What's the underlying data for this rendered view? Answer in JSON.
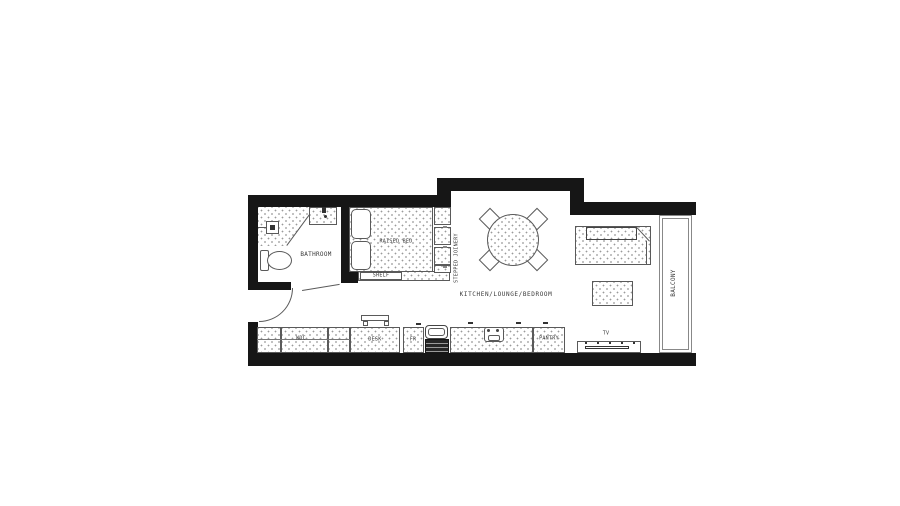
{
  "title": "Studio apartment floor plan",
  "rooms": {
    "bathroom": "BATHROOM",
    "main_room": "KITCHEN/LOUNGE/BEDROOM",
    "balcony": "BALCONY"
  },
  "labels": {
    "raised_bed": "RAISED BED",
    "shelf": "SHELF",
    "stepped_joinery": "STEPPED JOINERY",
    "wdc": "WDC",
    "desk": "DESK",
    "fridge": "FR",
    "pantry": "PANTRY",
    "tv": "TV"
  },
  "colors": {
    "wall": "#161616",
    "furniture_line": "#5a5a5a",
    "stipple_dot": "#9a9a9a",
    "label_text": "#3a3a3a",
    "background": "#ffffff"
  }
}
